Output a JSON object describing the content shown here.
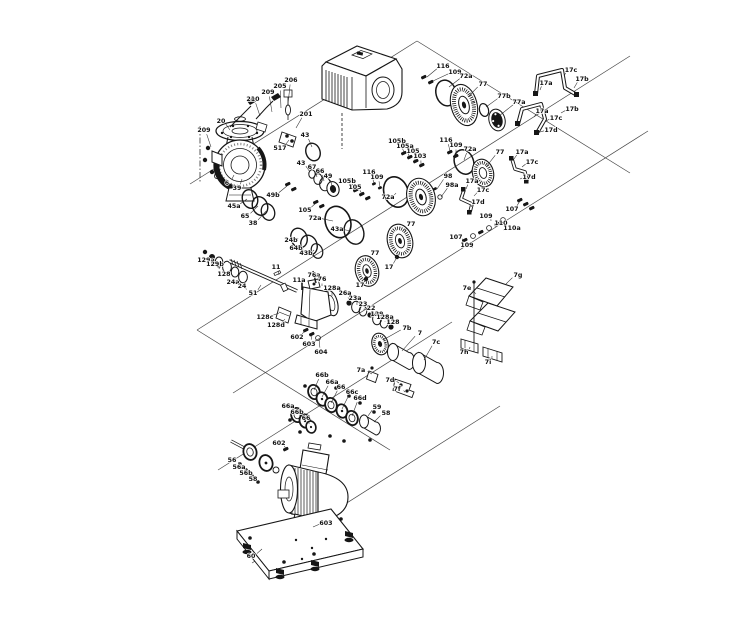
{
  "figure": {
    "type": "exploded-parts-diagram",
    "subject": "Exploded view technical drawing of a centrifugal pump assembly with numbered part callouts",
    "background_color": "#ffffff",
    "line_color": "#1a1a1a",
    "label_color": "#111111"
  },
  "part_labels": [
    {
      "t": "210",
      "x": 253,
      "y": 99,
      "tx": 260,
      "ty": 116
    },
    {
      "t": "209",
      "x": 268,
      "y": 92,
      "tx": 272,
      "ty": 112
    },
    {
      "t": "205",
      "x": 280,
      "y": 86,
      "tx": 281,
      "ty": 108
    },
    {
      "t": "206",
      "x": 291,
      "y": 80,
      "tx": 288,
      "ty": 104
    },
    {
      "t": "201",
      "x": 306,
      "y": 114,
      "tx": 296,
      "ty": 128
    },
    {
      "t": "517",
      "x": 280,
      "y": 148,
      "tx": 289,
      "ty": 140
    },
    {
      "t": "209",
      "x": 204,
      "y": 130,
      "tx": 211,
      "ty": 147
    },
    {
      "t": "20",
      "x": 221,
      "y": 121,
      "tx": 230,
      "ty": 130
    },
    {
      "t": "43",
      "x": 305,
      "y": 135,
      "tx": 312,
      "ty": 147
    },
    {
      "t": "6",
      "x": 227,
      "y": 183,
      "tx": 234,
      "ty": 175
    },
    {
      "t": "39",
      "x": 237,
      "y": 188,
      "tx": 242,
      "ty": 179
    },
    {
      "t": "45a",
      "x": 234,
      "y": 206,
      "tx": 247,
      "ty": 199
    },
    {
      "t": "65",
      "x": 245,
      "y": 216,
      "tx": 258,
      "ty": 206
    },
    {
      "t": "38",
      "x": 253,
      "y": 223,
      "tx": 266,
      "ty": 211
    },
    {
      "t": "49b",
      "x": 273,
      "y": 195,
      "tx": 287,
      "ty": 186
    },
    {
      "t": "43",
      "x": 301,
      "y": 163,
      "tx": 310,
      "ty": 172
    },
    {
      "t": "67",
      "x": 312,
      "y": 167,
      "tx": 317,
      "ty": 177
    },
    {
      "t": "66",
      "x": 320,
      "y": 171,
      "tx": 324,
      "ty": 181
    },
    {
      "t": "49",
      "x": 328,
      "y": 176,
      "tx": 332,
      "ty": 186
    },
    {
      "t": "105",
      "x": 305,
      "y": 210,
      "tx": 316,
      "ty": 203
    },
    {
      "t": "72a",
      "x": 315,
      "y": 218,
      "tx": 333,
      "ty": 221
    },
    {
      "t": "43a",
      "x": 337,
      "y": 229,
      "tx": 351,
      "ty": 231
    },
    {
      "t": "24b",
      "x": 291,
      "y": 240,
      "tx": 298,
      "ty": 238
    },
    {
      "t": "64b",
      "x": 296,
      "y": 248,
      "tx": 306,
      "ty": 245
    },
    {
      "t": "43b",
      "x": 306,
      "y": 253,
      "tx": 314,
      "ty": 250
    },
    {
      "t": "105b",
      "x": 347,
      "y": 181,
      "tx": 356,
      "ty": 189
    },
    {
      "t": "105",
      "x": 355,
      "y": 187,
      "tx": 362,
      "ty": 194
    },
    {
      "t": "116",
      "x": 369,
      "y": 172,
      "tx": 374,
      "ty": 183
    },
    {
      "t": "109",
      "x": 377,
      "y": 177,
      "tx": 380,
      "ty": 187
    },
    {
      "t": "72a",
      "x": 388,
      "y": 197,
      "tx": 396,
      "ty": 193
    },
    {
      "t": "98",
      "x": 448,
      "y": 176,
      "tx": 437,
      "ty": 189
    },
    {
      "t": "98a",
      "x": 452,
      "y": 185,
      "tx": 441,
      "ty": 197
    },
    {
      "t": "105b",
      "x": 397,
      "y": 141,
      "tx": 404,
      "ty": 152
    },
    {
      "t": "105a",
      "x": 405,
      "y": 146,
      "tx": 409,
      "ty": 156
    },
    {
      "t": "105",
      "x": 413,
      "y": 151,
      "tx": 415,
      "ty": 160
    },
    {
      "t": "103",
      "x": 420,
      "y": 156,
      "tx": 421,
      "ty": 164
    },
    {
      "t": "116",
      "x": 446,
      "y": 140,
      "tx": 450,
      "ty": 151
    },
    {
      "t": "109",
      "x": 456,
      "y": 145,
      "tx": 456,
      "ty": 155
    },
    {
      "t": "72a",
      "x": 470,
      "y": 149,
      "tx": 464,
      "ty": 160
    },
    {
      "t": "77",
      "x": 500,
      "y": 152,
      "tx": 486,
      "ty": 167
    },
    {
      "t": "116",
      "x": 443,
      "y": 66,
      "tx": 427,
      "ty": 77
    },
    {
      "t": "109",
      "x": 455,
      "y": 72,
      "tx": 433,
      "ty": 81
    },
    {
      "t": "72a",
      "x": 466,
      "y": 76,
      "tx": 449,
      "ty": 87
    },
    {
      "t": "77",
      "x": 483,
      "y": 84,
      "tx": 468,
      "ty": 97
    },
    {
      "t": "77b",
      "x": 504,
      "y": 96,
      "tx": 486,
      "ty": 107
    },
    {
      "t": "77a",
      "x": 519,
      "y": 102,
      "tx": 499,
      "ty": 116
    },
    {
      "t": "17a",
      "x": 546,
      "y": 83,
      "tx": 540,
      "ty": 90
    },
    {
      "t": "17c",
      "x": 571,
      "y": 70,
      "tx": 564,
      "ty": 76
    },
    {
      "t": "17b",
      "x": 582,
      "y": 79,
      "tx": 574,
      "ty": 88
    },
    {
      "t": "17a",
      "x": 542,
      "y": 111,
      "tx": 534,
      "ty": 117
    },
    {
      "t": "17b",
      "x": 572,
      "y": 109,
      "tx": 561,
      "ty": 113
    },
    {
      "t": "17c",
      "x": 556,
      "y": 118,
      "tx": 546,
      "ty": 121
    },
    {
      "t": "17d",
      "x": 551,
      "y": 130,
      "tx": 540,
      "ty": 132
    },
    {
      "t": "17a",
      "x": 522,
      "y": 152,
      "tx": 514,
      "ty": 159
    },
    {
      "t": "17c",
      "x": 532,
      "y": 162,
      "tx": 522,
      "ty": 167
    },
    {
      "t": "17d",
      "x": 529,
      "y": 177,
      "tx": 520,
      "ty": 179
    },
    {
      "t": "17a",
      "x": 472,
      "y": 181,
      "tx": 466,
      "ty": 189
    },
    {
      "t": "17c",
      "x": 483,
      "y": 190,
      "tx": 474,
      "ty": 196
    },
    {
      "t": "17d",
      "x": 478,
      "y": 202,
      "tx": 471,
      "ty": 207
    },
    {
      "t": "107",
      "x": 512,
      "y": 209,
      "tx": 520,
      "ty": 201
    },
    {
      "t": "109",
      "x": 486,
      "y": 216,
      "tx": 491,
      "ty": 221
    },
    {
      "t": "110",
      "x": 501,
      "y": 223,
      "tx": 497,
      "ty": 226
    },
    {
      "t": "110a",
      "x": 512,
      "y": 228,
      "tx": 503,
      "ty": 230
    },
    {
      "t": "107",
      "x": 456,
      "y": 237,
      "tx": 463,
      "ty": 240
    },
    {
      "t": "109",
      "x": 467,
      "y": 245,
      "tx": 470,
      "ty": 247
    },
    {
      "t": "129a",
      "x": 206,
      "y": 260,
      "tx": 212,
      "ty": 265
    },
    {
      "t": "129b",
      "x": 215,
      "y": 264,
      "tx": 219,
      "ty": 269
    },
    {
      "t": "128",
      "x": 224,
      "y": 274,
      "tx": 228,
      "ty": 276
    },
    {
      "t": "24a",
      "x": 233,
      "y": 282,
      "tx": 236,
      "ty": 283
    },
    {
      "t": "24",
      "x": 242,
      "y": 286,
      "tx": 244,
      "ty": 288
    },
    {
      "t": "51",
      "x": 253,
      "y": 293,
      "tx": 261,
      "ty": 285
    },
    {
      "t": "11",
      "x": 276,
      "y": 267,
      "tx": 279,
      "ty": 275
    },
    {
      "t": "11a",
      "x": 299,
      "y": 280,
      "tx": 302,
      "ty": 286
    },
    {
      "t": "76a",
      "x": 314,
      "y": 275,
      "tx": 315,
      "ty": 282
    },
    {
      "t": "76",
      "x": 322,
      "y": 279,
      "tx": 322,
      "ty": 286
    },
    {
      "t": "128a",
      "x": 332,
      "y": 288,
      "tx": 332,
      "ty": 296
    },
    {
      "t": "128c",
      "x": 265,
      "y": 317,
      "tx": 279,
      "ty": 313
    },
    {
      "t": "128d",
      "x": 276,
      "y": 325,
      "tx": 285,
      "ty": 319
    },
    {
      "t": "26a",
      "x": 345,
      "y": 293,
      "tx": 349,
      "ty": 301
    },
    {
      "t": "23a",
      "x": 355,
      "y": 298,
      "tx": 357,
      "ty": 305
    },
    {
      "t": "23",
      "x": 363,
      "y": 304,
      "tx": 364,
      "ty": 310
    },
    {
      "t": "22",
      "x": 371,
      "y": 308,
      "tx": 372,
      "ty": 314
    },
    {
      "t": "129",
      "x": 377,
      "y": 314,
      "tx": 378,
      "ty": 318
    },
    {
      "t": "128a",
      "x": 385,
      "y": 317,
      "tx": 385,
      "ty": 322
    },
    {
      "t": "128",
      "x": 393,
      "y": 322,
      "tx": 392,
      "ty": 326
    },
    {
      "t": "7b",
      "x": 407,
      "y": 328,
      "tx": 383,
      "ty": 340
    },
    {
      "t": "7",
      "x": 420,
      "y": 333,
      "tx": 402,
      "ty": 351
    },
    {
      "t": "7c",
      "x": 436,
      "y": 342,
      "tx": 424,
      "ty": 360
    },
    {
      "t": "7a",
      "x": 361,
      "y": 370,
      "tx": 372,
      "ty": 374
    },
    {
      "t": "7d",
      "x": 390,
      "y": 380,
      "tx": 399,
      "ty": 383
    },
    {
      "t": "7f",
      "x": 397,
      "y": 389,
      "tx": 405,
      "ty": 392
    },
    {
      "t": "602",
      "x": 297,
      "y": 337,
      "tx": 305,
      "ty": 330
    },
    {
      "t": "603",
      "x": 309,
      "y": 344,
      "tx": 312,
      "ty": 335
    },
    {
      "t": "604",
      "x": 321,
      "y": 352,
      "tx": 319,
      "ty": 339
    },
    {
      "t": "7e",
      "x": 467,
      "y": 288,
      "tx": 476,
      "ty": 294
    },
    {
      "t": "7g",
      "x": 518,
      "y": 275,
      "tx": 506,
      "ty": 284
    },
    {
      "t": "7h",
      "x": 464,
      "y": 352,
      "tx": 470,
      "ty": 347
    },
    {
      "t": "7i",
      "x": 488,
      "y": 362,
      "tx": 492,
      "ty": 356
    },
    {
      "t": "77",
      "x": 411,
      "y": 224,
      "tx": 404,
      "ty": 233
    },
    {
      "t": "17",
      "x": 389,
      "y": 267,
      "tx": 397,
      "ty": 257
    },
    {
      "t": "77",
      "x": 375,
      "y": 253,
      "tx": 369,
      "ty": 261
    },
    {
      "t": "17",
      "x": 360,
      "y": 285,
      "tx": 366,
      "ty": 279
    },
    {
      "t": "66b",
      "x": 322,
      "y": 375,
      "tx": 314,
      "ty": 390
    },
    {
      "t": "66a",
      "x": 332,
      "y": 382,
      "tx": 322,
      "ty": 397
    },
    {
      "t": "66",
      "x": 341,
      "y": 387,
      "tx": 331,
      "ty": 403
    },
    {
      "t": "66c",
      "x": 352,
      "y": 392,
      "tx": 342,
      "ty": 409
    },
    {
      "t": "66d",
      "x": 360,
      "y": 398,
      "tx": 352,
      "ty": 416
    },
    {
      "t": "66a",
      "x": 288,
      "y": 406,
      "tx": 296,
      "ty": 413
    },
    {
      "t": "66b",
      "x": 297,
      "y": 412,
      "tx": 303,
      "ty": 419
    },
    {
      "t": "66",
      "x": 306,
      "y": 418,
      "tx": 309,
      "ty": 424
    },
    {
      "t": "59",
      "x": 377,
      "y": 407,
      "tx": 368,
      "ty": 416
    },
    {
      "t": "58",
      "x": 386,
      "y": 413,
      "tx": 374,
      "ty": 422
    },
    {
      "t": "56",
      "x": 232,
      "y": 460,
      "tx": 240,
      "ty": 464
    },
    {
      "t": "56a",
      "x": 239,
      "y": 467,
      "tx": 246,
      "ty": 470
    },
    {
      "t": "56b",
      "x": 246,
      "y": 473,
      "tx": 252,
      "ty": 476
    },
    {
      "t": "58",
      "x": 253,
      "y": 479,
      "tx": 258,
      "ty": 482
    },
    {
      "t": "602",
      "x": 279,
      "y": 443,
      "tx": 286,
      "ty": 449
    },
    {
      "t": "603",
      "x": 326,
      "y": 523,
      "tx": 313,
      "ty": 527
    },
    {
      "t": "60",
      "x": 251,
      "y": 556,
      "tx": 262,
      "ty": 549
    }
  ]
}
